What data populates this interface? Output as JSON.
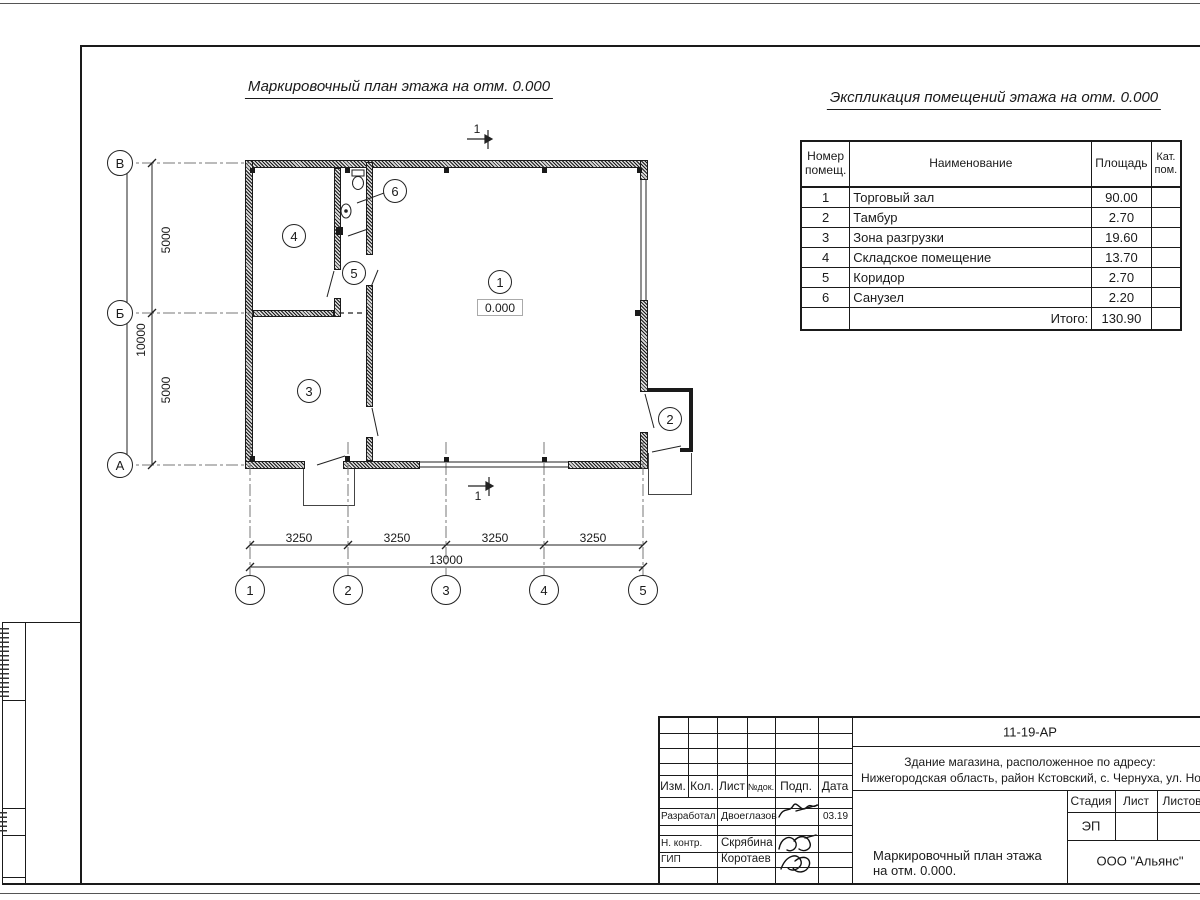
{
  "titles": {
    "plan": "Маркировочный план этажа на отм. 0.000",
    "explication": "Экспликация помещений этажа на отм. 0.000"
  },
  "explication": {
    "headers": {
      "num": "Номер помещ.",
      "name": "Наименование",
      "area": "Площадь",
      "cat": "Кат. пом."
    },
    "rows": [
      {
        "num": "1",
        "name": "Торговый зал",
        "area": "90.00"
      },
      {
        "num": "2",
        "name": "Тамбур",
        "area": "2.70"
      },
      {
        "num": "3",
        "name": "Зона разгрузки",
        "area": "19.60"
      },
      {
        "num": "4",
        "name": "Складское помещение",
        "area": "13.70"
      },
      {
        "num": "5",
        "name": "Коридор",
        "area": "2.70"
      },
      {
        "num": "6",
        "name": "Санузел",
        "area": "2.20"
      }
    ],
    "total_label": "Итого:",
    "total_value": "130.90"
  },
  "plan": {
    "level_mark": "0.000",
    "section_label": "1",
    "room_labels": [
      "1",
      "2",
      "3",
      "4",
      "5",
      "6"
    ],
    "axis_rows": [
      "В",
      "Б",
      "А"
    ],
    "axis_cols": [
      "1",
      "2",
      "3",
      "4",
      "5"
    ],
    "dims": {
      "v": [
        "5000",
        "5000"
      ],
      "v_total": "10000",
      "h": [
        "3250",
        "3250",
        "3250",
        "3250"
      ],
      "h_total": "13000"
    }
  },
  "stamp": {
    "doc_number": "11-19-АР",
    "project_line1": "Здание магазина, расположенное по адресу:",
    "project_line2": "Нижегородская область, район Кстовский, с. Чернуха, ул. Нов",
    "cols": {
      "izm": "Изм.",
      "kol": "Кол.",
      "list": "Лист",
      "doc": "№док.",
      "podp": "Подп.",
      "date": "Дата"
    },
    "rows": [
      {
        "role": "Разработал",
        "name": "Двоеглазов",
        "date": "03.19"
      },
      {
        "role": "Н. контр.",
        "name": "Скрябина",
        "date": ""
      },
      {
        "role": "ГИП",
        "name": "Коротаев",
        "date": ""
      }
    ],
    "stage_label": "Стадия",
    "sheet_label": "Лист",
    "sheets_label": "Листов",
    "stage_value": "ЭП",
    "title_line1": "Маркировочный план этажа",
    "title_line2": "на отм. 0.000.",
    "company": "ООО \"Альянс\""
  }
}
